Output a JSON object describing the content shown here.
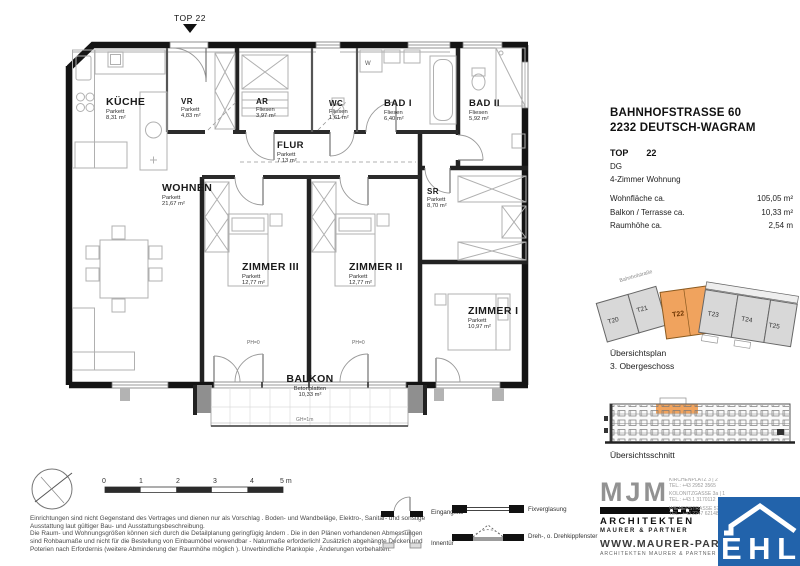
{
  "meta": {
    "top_marker": "TOP 22"
  },
  "plan": {
    "rooms": [
      {
        "name": "KÜCHE",
        "floor": "Parkett",
        "area": "8,31 m²"
      },
      {
        "name": "VR",
        "floor": "Parkett",
        "area": "4,83 m²"
      },
      {
        "name": "AR",
        "floor": "Fliesen",
        "area": "3,97 m²"
      },
      {
        "name": "WC",
        "floor": "Fliesen",
        "area": "1,61 m²"
      },
      {
        "name": "BAD I",
        "floor": "Fliesen",
        "area": "6,40 m²"
      },
      {
        "name": "BAD II",
        "floor": "Fliesen",
        "area": "5,92 m²"
      },
      {
        "name": "FLUR",
        "floor": "Parkett",
        "area": "7,13 m²"
      },
      {
        "name": "WOHNEN",
        "floor": "Parkett",
        "area": "21,67 m²"
      },
      {
        "name": "ZIMMER III",
        "floor": "Parkett",
        "area": "12,77 m²"
      },
      {
        "name": "ZIMMER II",
        "floor": "Parkett",
        "area": "12,77 m²"
      },
      {
        "name": "SR",
        "floor": "Parkett",
        "area": "8,70 m²"
      },
      {
        "name": "ZIMMER I",
        "floor": "Parkett",
        "area": "10,97 m²"
      },
      {
        "name": "BALKON",
        "floor": "Betonplatten",
        "area": "10,33 m²"
      }
    ],
    "annotations": {
      "ph1": "PH=0",
      "ph2": "PH=0",
      "gh": "GH=1m",
      "washer": "W"
    }
  },
  "info": {
    "address_line1": "BAHNHOFSTRASSE 60",
    "address_line2": "2232 DEUTSCH-WAGRAM",
    "top_label": "TOP",
    "top_number": "22",
    "level": "DG",
    "type": "4-Zimmer Wohnung",
    "metrics": [
      {
        "label": "Wohnfläche ca.",
        "value": "105,05 m²"
      },
      {
        "label": "Balkon / Terrasse ca.",
        "value": "10,33 m²"
      },
      {
        "label": "Raumhöhe ca.",
        "value": "2,54 m"
      }
    ]
  },
  "overview_plan": {
    "street": "Bahnhofstraße",
    "units": [
      "T20",
      "T21",
      "T22",
      "T23",
      "T24",
      "T25"
    ],
    "caption_line1": "Übersichtsplan",
    "caption_line2": "3. Obergeschoss",
    "highlight_color": "#f0a35e"
  },
  "overview_section": {
    "caption": "Übersichtsschnitt"
  },
  "scale_bar": {
    "ticks": [
      "0",
      "1",
      "2",
      "3",
      "4",
      "5 m"
    ]
  },
  "legend": {
    "items": [
      {
        "label": "Eingangstür"
      },
      {
        "label": "Innentür"
      },
      {
        "label": "Fixverglasung"
      },
      {
        "label": "Dreh-, o. Drehkippfenster"
      }
    ]
  },
  "disclaimer": {
    "line1": "Einrichtungen sind nicht Gegenstand des Vertrages und dienen nur als Vorschlag . Boden- und Wandbeläge, Elektro-, Sanitär- und sonstige",
    "line2": "Ausstattung laut gültiger Bau- und Ausstattungsbeschreibung.",
    "line3": "Die Raum- und Wohnungsgrößen können sich durch die Detailplanung geringfügig ändern . Die in den Plänen vorhandenen Abmessungen",
    "line4": "sind Rohbaumaße und nicht für die Bestellung von Einbaumöbel verwendbar - Naturmaße erforderlich! Zusätzlich abgehängte Decken und",
    "line5": "Poterien nach Erfordernis (weitere Abminderung der Raumhöhe möglich ). Unverbindliche Plankopie , Änderungen vorbehalten."
  },
  "branding": {
    "mjm_logo": "MJM",
    "mjm_line1": "ARCHITEKTEN",
    "mjm_line2": "MAURER & PARTNER",
    "contact1a": "KIRCHENPLATZ 3 | 2",
    "contact1b": "TEL.: +43 2952 3565",
    "contact2a": "KOLONITZGASSE 3a | 1",
    "contact2b": "TEL.: +43 1 3170112",
    "contact3a": "WIENERSTRASSE 57/10 | 2",
    "contact3b": "TEL.: +43 2247 62148",
    "website": "WWW.MAURER-PARTNER",
    "website_sub": "ARCHITEKTEN MAURER & PARTNER ZT G",
    "ehl_logo": "EHL",
    "ehl_blue": "#2263ab"
  }
}
